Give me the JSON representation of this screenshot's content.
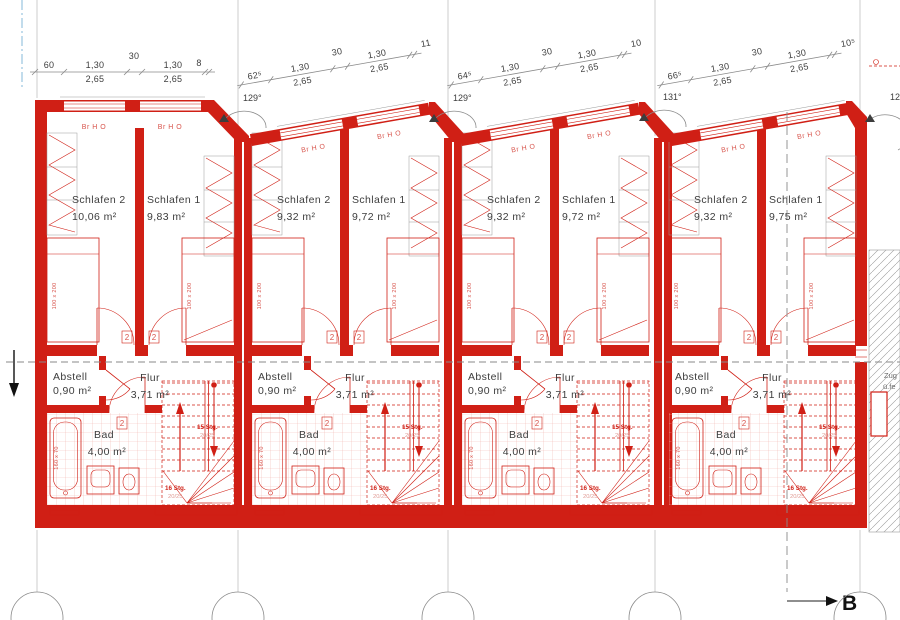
{
  "plan": {
    "section_label": "B",
    "angles": [
      "129°",
      "129°",
      "131°",
      "12"
    ],
    "side_note": {
      "line1": "Zug",
      "line2": "ü.fe"
    },
    "units": [
      {
        "dims": {
          "offset": "60",
          "win1": "1,30",
          "h1": "2,65",
          "pier": "30",
          "win2": "1,30",
          "h2": "2,65",
          "end": "8"
        },
        "windows": [
          "Br H O",
          "Br H O"
        ],
        "rooms": {
          "schlafen2": {
            "label": "Schlafen 2",
            "area": "10,06 m²"
          },
          "schlafen1": {
            "label": "Schlafen 1",
            "area": "9,83 m²"
          },
          "abstell": {
            "label": "Abstell",
            "area": "0,90 m²"
          },
          "flur": {
            "label": "Flur",
            "area": "3,71 m²"
          },
          "bad": {
            "label": "Bad",
            "area": "4,00 m²"
          }
        },
        "fixtures": {
          "bed_label": "100 x 200",
          "tub_label": "160 x 70",
          "door_tag": "2",
          "stairs_up": "15 Stg.",
          "stairs_up_detail": "20/25",
          "stairs_down": "16 Stg.",
          "stairs_down_detail": "20/25"
        }
      },
      {
        "dims": {
          "offset": "62⁵",
          "win1": "1,30",
          "h1": "2,65",
          "pier": "30",
          "win2": "1,30",
          "h2": "2,65",
          "end": "11"
        },
        "windows": [
          "Br H O",
          "Br H O"
        ],
        "rooms": {
          "schlafen2": {
            "label": "Schlafen 2",
            "area": "9,32 m²"
          },
          "schlafen1": {
            "label": "Schlafen 1",
            "area": "9,72 m²"
          },
          "abstell": {
            "label": "Abstell",
            "area": "0,90 m²"
          },
          "flur": {
            "label": "Flur",
            "area": "3,71 m²"
          },
          "bad": {
            "label": "Bad",
            "area": "4,00 m²"
          }
        },
        "fixtures": {
          "bed_label": "100 x 200",
          "tub_label": "160 x 70",
          "door_tag": "2",
          "stairs_up": "15 Stg.",
          "stairs_up_detail": "20/25",
          "stairs_down": "16 Stg.",
          "stairs_down_detail": "20/25"
        }
      },
      {
        "dims": {
          "offset": "64⁵",
          "win1": "1,30",
          "h1": "2,65",
          "pier": "30",
          "win2": "1,30",
          "h2": "2,65",
          "end": "10"
        },
        "windows": [
          "Br H O",
          "Br H O"
        ],
        "rooms": {
          "schlafen2": {
            "label": "Schlafen 2",
            "area": "9,32 m²"
          },
          "schlafen1": {
            "label": "Schlafen 1",
            "area": "9,72 m²"
          },
          "abstell": {
            "label": "Abstell",
            "area": "0,90 m²"
          },
          "flur": {
            "label": "Flur",
            "area": "3,71 m²"
          },
          "bad": {
            "label": "Bad",
            "area": "4,00 m²"
          }
        },
        "fixtures": {
          "bed_label": "100 x 200",
          "tub_label": "160 x 70",
          "door_tag": "2",
          "stairs_up": "15 Stg.",
          "stairs_up_detail": "20/25",
          "stairs_down": "16 Stg.",
          "stairs_down_detail": "20/25"
        }
      },
      {
        "dims": {
          "offset": "66⁵",
          "win1": "1,30",
          "h1": "2,65",
          "pier": "30",
          "win2": "1,30",
          "h2": "2,65",
          "end": "10⁵"
        },
        "windows": [
          "Br H O",
          "Br H O"
        ],
        "rooms": {
          "schlafen2": {
            "label": "Schlafen 2",
            "area": "9,32 m²"
          },
          "schlafen1": {
            "label": "Schlafen 1",
            "area": "9,75 m²"
          },
          "abstell": {
            "label": "Abstell",
            "area": "0,90 m²"
          },
          "flur": {
            "label": "Flur",
            "area": "3,71 m²"
          },
          "bad": {
            "label": "Bad",
            "area": "4,00 m²"
          }
        },
        "fixtures": {
          "bed_label": "100 x 200",
          "tub_label": "160 x 70",
          "door_tag": "2",
          "stairs_up": "15 Stg.",
          "stairs_up_detail": "20/25",
          "stairs_down": "16 Stg.",
          "stairs_down_detail": "20/25"
        }
      }
    ]
  }
}
